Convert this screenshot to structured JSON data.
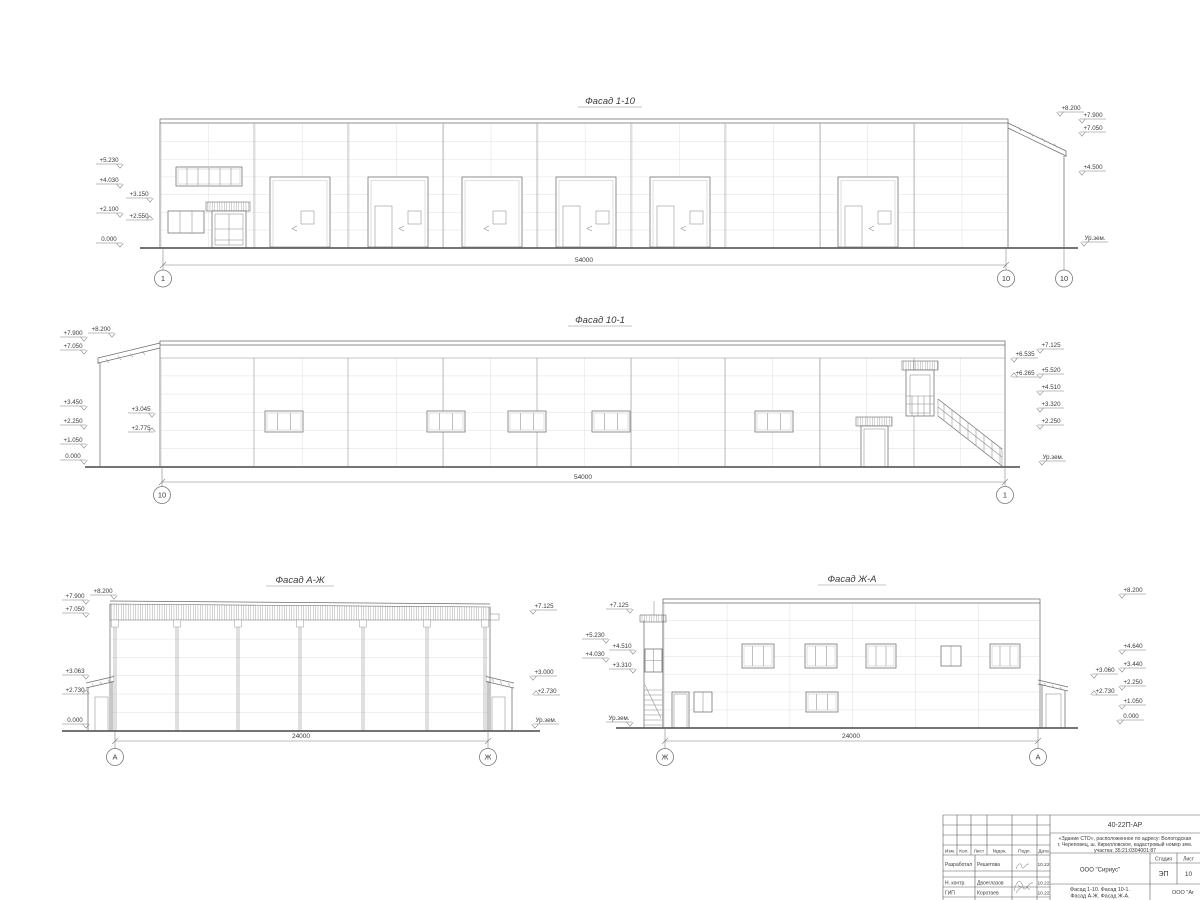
{
  "facades": {
    "f1_10": {
      "title": "Фасад 1-10",
      "marks_left": [
        "+5.230",
        "+4.030",
        "+3.150",
        "+2.100",
        "+2.550",
        "0.000"
      ],
      "marks_right": [
        "+8.200",
        "+7.900",
        "+7.050",
        "+4.500",
        "Ур.зем."
      ],
      "dim": "54000",
      "axis_left": "1",
      "axis_right": "10",
      "axis_canopy": "10"
    },
    "f10_1": {
      "title": "Фасад 10-1",
      "marks_left": [
        "+7.900",
        "+7.050",
        "+8.200",
        "+3.450",
        "+2.250",
        "+1.050",
        "0.000",
        "+3.045",
        "+2.775"
      ],
      "marks_right": [
        "+7.125",
        "+6.535",
        "+6.265",
        "+5.520",
        "+4.510",
        "+3.320",
        "+2.250",
        "Ур.зем."
      ],
      "dim": "54000",
      "axis_left": "10",
      "axis_right": "1"
    },
    "f_azh": {
      "title": "Фасад А-Ж",
      "marks_left": [
        "+7.900",
        "+7.050",
        "+8.200",
        "+3.063",
        "+2.730",
        "0.000"
      ],
      "marks_right": [
        "+7.125",
        "+3.000",
        "+2.730",
        "Ур.зем."
      ],
      "dim": "24000",
      "axis_left": "А",
      "axis_right": "Ж"
    },
    "f_zha": {
      "title": "Фасад Ж-А",
      "marks_left": [
        "+7.125",
        "+5.230",
        "+4.510",
        "+4.030",
        "+3.310",
        "Ур.зем."
      ],
      "marks_right": [
        "+8.200",
        "+4.640",
        "+3.440",
        "+3.060",
        "+2.250",
        "+2.730",
        "+1.050",
        "0.000"
      ],
      "dim": "24000",
      "axis_left": "Ж",
      "axis_right": "А"
    }
  },
  "titleblock": {
    "doc_number": "40-22П-АР",
    "desc1": "«Здание СТО», расположенное по адресу: Вологодская",
    "desc2": "г. Череповец, ш. Кирилловское, кадастровый номер зем.",
    "desc3": "участка: 35:21:0304001:87",
    "rev_headers": [
      "Изм.",
      "Кол.",
      "Лист",
      "№док.",
      "Подп.",
      "Дата"
    ],
    "rows": [
      {
        "role": "Разработал",
        "name": "Решетова",
        "date": "10.22"
      },
      {
        "role": "Н. контр.",
        "name": "Двоеглазов",
        "date": "10.22"
      },
      {
        "role": "ГИП",
        "name": "Коротаев",
        "date": "10.22"
      }
    ],
    "org": "ООО \"Сириус\"",
    "stage_label": "Стадия",
    "sheet_label": "Лист",
    "stage": "ЭП",
    "sheet_no": "10",
    "sheet_title1": "Фасад 1-10. Фасад 10-1.",
    "sheet_title2": "Фасад А-Ж. Фасад Ж-А.",
    "org2": "ООО \"Аг"
  }
}
